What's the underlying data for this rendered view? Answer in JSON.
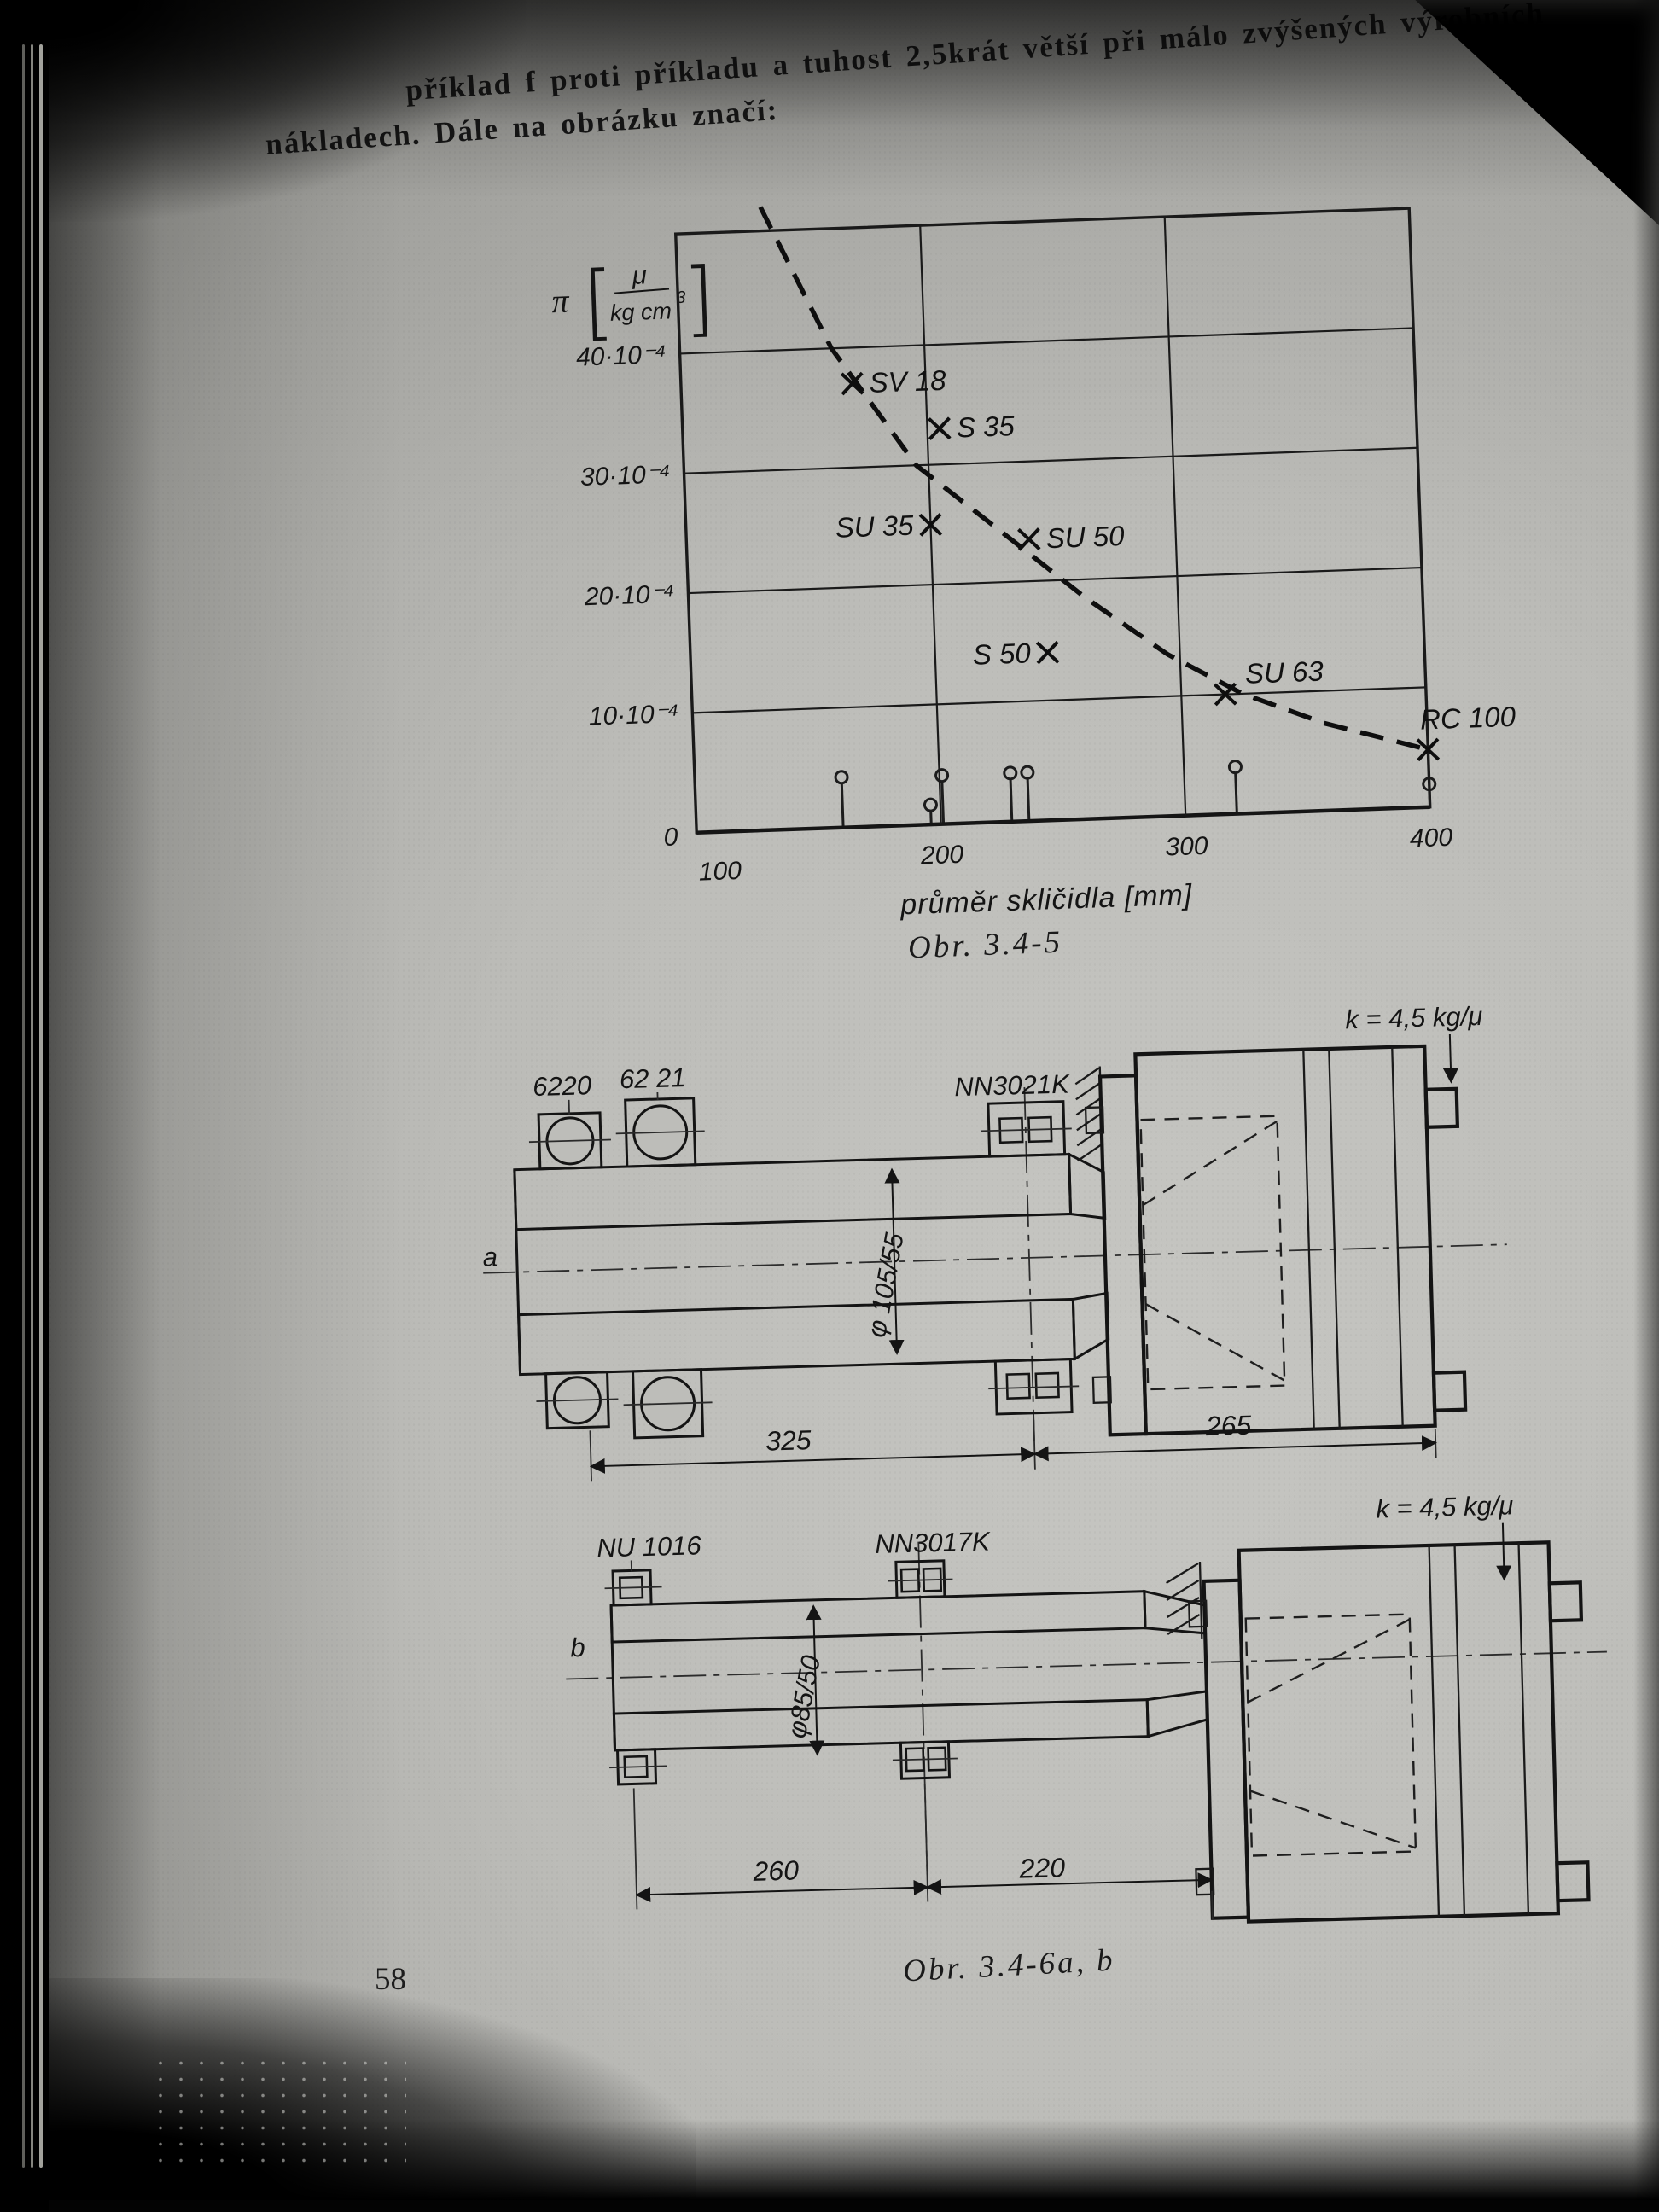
{
  "page": {
    "number": "58",
    "paragraph": {
      "line1": "příklad f proti příkladu a tuhost 2,5krát větší při málo zvýšených výrobních",
      "line2": "nákladech. Dále na obrázku značí:"
    }
  },
  "chart": {
    "caption": "Obr. 3.4-5",
    "unit": {
      "symbol": "π",
      "bracket_open": "[",
      "numerator": "μ",
      "denominator": "kg cm",
      "exponent": "3",
      "bracket_close": "]"
    }
  },
  "chart_data": {
    "type": "scatter",
    "title": "",
    "xlabel": "průměr skličidla [mm]",
    "ylabel": "π [μ/kg cm³]",
    "xlim": [
      100,
      400
    ],
    "ylim": [
      0,
      50
    ],
    "grid": true,
    "origin_label": "0",
    "x_ticks": [
      {
        "value": 100,
        "label": "100"
      },
      {
        "value": 200,
        "label": "200"
      },
      {
        "value": 300,
        "label": "300"
      },
      {
        "value": 400,
        "label": "400"
      }
    ],
    "y_ticks": [
      {
        "value": 40,
        "label": "40·10⁻⁴"
      },
      {
        "value": 30,
        "label": "30·10⁻⁴"
      },
      {
        "value": 20,
        "label": "20·10⁻⁴"
      },
      {
        "value": 10,
        "label": "10·10⁻⁴"
      }
    ],
    "x_gridlines": [
      200,
      300
    ],
    "y_gridlines": [
      10,
      20,
      30,
      40
    ],
    "points": [
      {
        "label": "SV 18",
        "x": 170,
        "y": 37,
        "side": "right"
      },
      {
        "label": "S 35",
        "x": 205,
        "y": 33,
        "side": "right"
      },
      {
        "label": "SU 35",
        "x": 200,
        "y": 25,
        "side": "left"
      },
      {
        "label": "SU 50",
        "x": 240,
        "y": 23.5,
        "side": "right"
      },
      {
        "label": "S 50",
        "x": 246,
        "y": 14,
        "side": "left"
      },
      {
        "label": "SU 63",
        "x": 318,
        "y": 10,
        "side": "right-up"
      },
      {
        "label": "RC 100",
        "x": 400,
        "y": 4.8,
        "side": "up"
      }
    ],
    "trend_curve_dashed": [
      [
        135,
        52
      ],
      [
        162,
        40
      ],
      [
        195,
        30
      ],
      [
        230,
        24
      ],
      [
        262,
        18.5
      ],
      [
        295,
        13.5
      ],
      [
        325,
        10
      ],
      [
        358,
        7.3
      ],
      [
        400,
        4.8
      ]
    ],
    "axis_pins_x": [
      {
        "x": 160,
        "h": 52
      },
      {
        "x": 196,
        "h": 16
      },
      {
        "x": 201,
        "h": 50
      },
      {
        "x": 229,
        "h": 50
      },
      {
        "x": 236,
        "h": 50
      },
      {
        "x": 321,
        "h": 48
      },
      {
        "x": 400,
        "h": 20
      }
    ]
  },
  "figure_a": {
    "label_bearing_1": "6220",
    "label_bearing_2": "62 21",
    "label_bearing_3": "NN3021K",
    "label_stiffness": "k = 4,5 kg/μ",
    "label_shaft": "a",
    "label_diameter": "φ 105/55",
    "dim_left": "325",
    "dim_right": "265"
  },
  "figure_b": {
    "label_bearing_1": "NU 1016",
    "label_bearing_2": "NN3017K",
    "label_stiffness": "k = 4,5 kg/μ",
    "label_shaft": "b",
    "label_diameter": "φ85/50",
    "dim_left": "260",
    "dim_right": "220",
    "caption": "Obr. 3.4-6a, b"
  }
}
